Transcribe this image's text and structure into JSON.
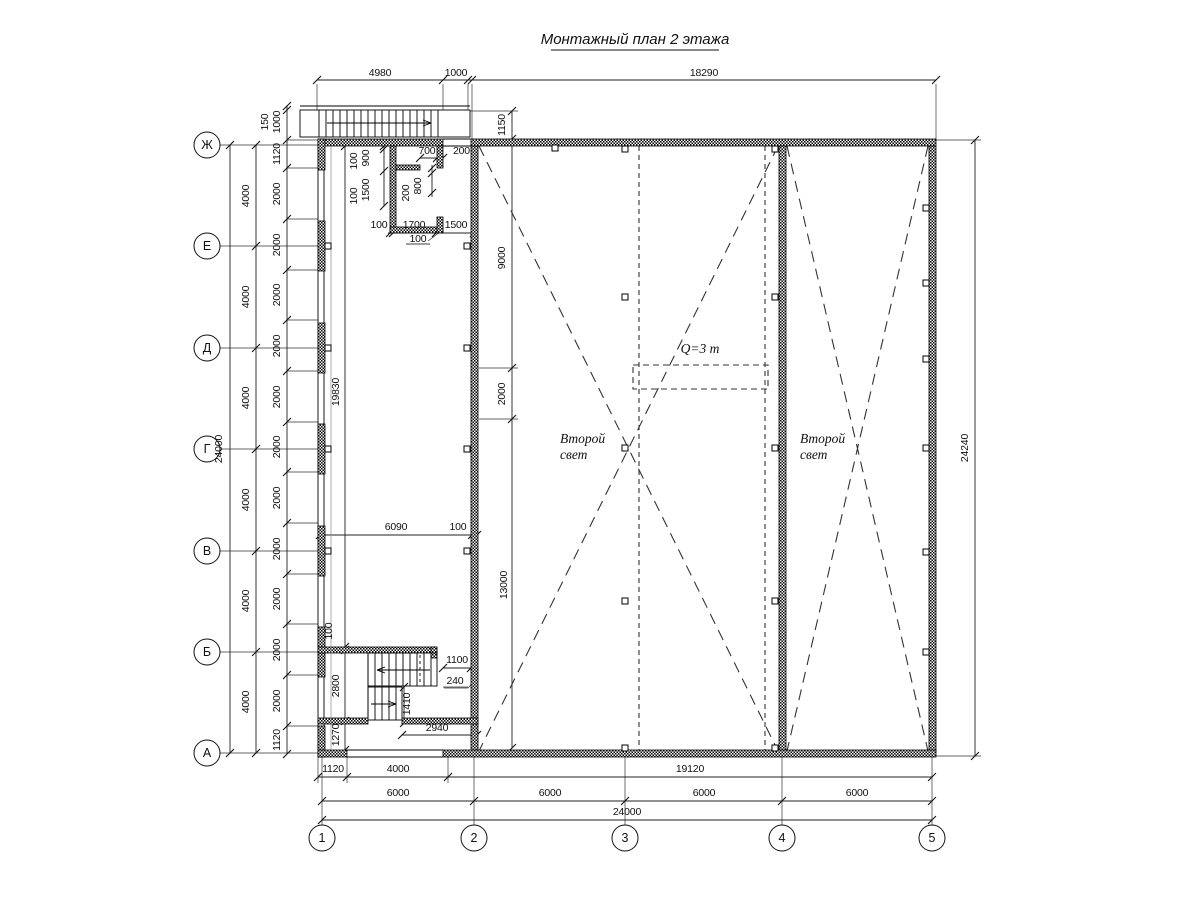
{
  "title": "Монтажный план 2 этажа",
  "annotations": {
    "second_light_line1": "Второй",
    "second_light_line2": "свет",
    "crane_capacity": "Q=3 т"
  },
  "axes": {
    "rows": [
      "Ж",
      "Е",
      "Д",
      "Г",
      "В",
      "Б",
      "А"
    ],
    "cols": [
      "1",
      "2",
      "3",
      "4",
      "5"
    ]
  },
  "dims": {
    "top": [
      "4980",
      "1000",
      "18290"
    ],
    "stair_top": [
      "150",
      "1000",
      "1150"
    ],
    "left_total": "24000",
    "left_4000": [
      "4000",
      "4000",
      "4000",
      "4000",
      "4000",
      "4000"
    ],
    "left_inner": [
      "1120",
      "2000",
      "2000",
      "2000",
      "2000",
      "2000",
      "2000",
      "2000",
      "2000",
      "2000",
      "2000",
      "2000",
      "1120"
    ],
    "right_total": "24240",
    "room": [
      "100",
      "900",
      "100",
      "1500",
      "700",
      "200",
      "200",
      "800",
      "100",
      "1700",
      "1500",
      "100"
    ],
    "left_block": [
      "6090",
      "100",
      "19830",
      "100",
      "2800",
      "1270"
    ],
    "hall": [
      "9000",
      "2000",
      "13000"
    ],
    "stair_bottom": [
      "1100",
      "240",
      "1410",
      "2940"
    ],
    "bottom_detail": [
      "1120",
      "4000",
      "19120"
    ],
    "bottom_6000": [
      "6000",
      "6000",
      "6000",
      "6000"
    ],
    "bottom_total": "24000"
  }
}
